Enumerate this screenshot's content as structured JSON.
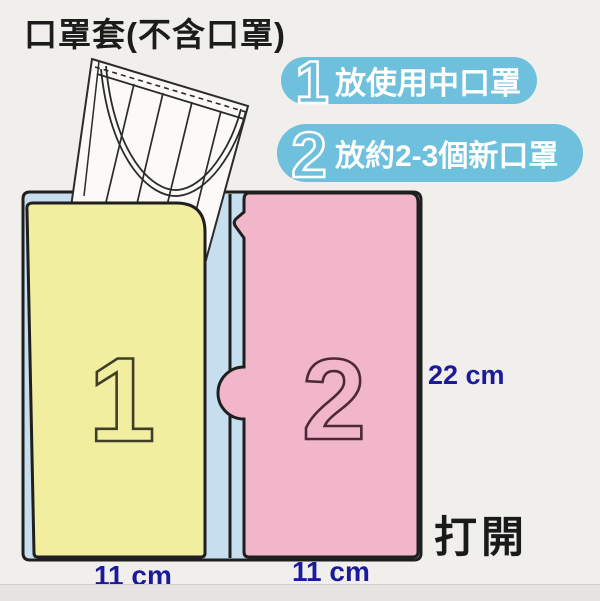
{
  "title": "口罩套(不含口罩)",
  "callout1": {
    "number": "1",
    "text": "放使用中口罩"
  },
  "callout2": {
    "number": "2",
    "text": "放約2-3個新口罩"
  },
  "pockets": {
    "left_number": "1",
    "right_number": "2"
  },
  "dimensions": {
    "height": "22 cm",
    "left_width": "11 cm",
    "right_width": "11 cm"
  },
  "open_label": "打開",
  "colors": {
    "callout_blue": "#6fc0dd",
    "pocket_left_yellow": "#f2eea0",
    "pocket_right_pink": "#f1b6ca",
    "backing_blue": "#c6deed",
    "mask_white": "#fbfaf7",
    "outline_black": "#1f1f1f",
    "dimension_text": "#1b1b99"
  }
}
